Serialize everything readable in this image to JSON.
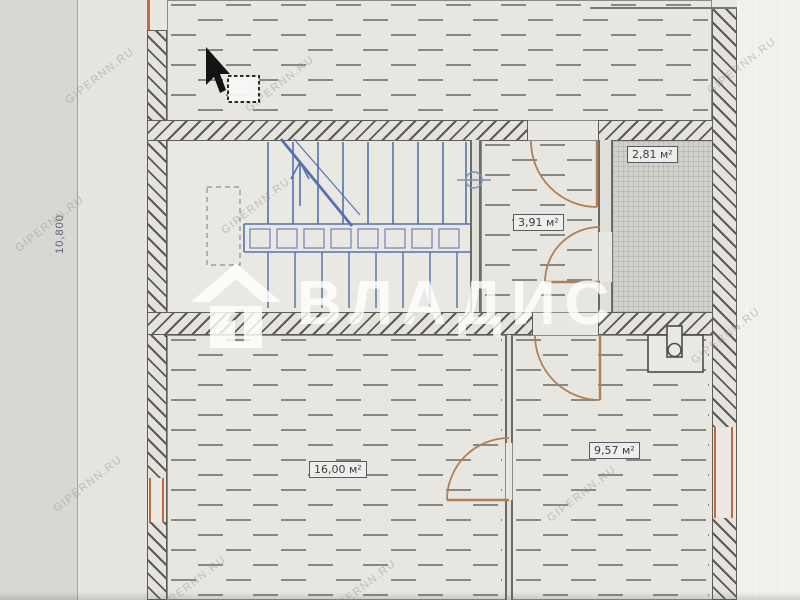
{
  "plan": {
    "rooms": [
      {
        "area_label": "2,81 м²"
      },
      {
        "area_label": "3,91 м²"
      },
      {
        "area_label": "16,00 м²"
      },
      {
        "area_label": "9,57 м²"
      }
    ],
    "dimension_left": "10,800"
  },
  "watermarks": {
    "brand": "ВЛАДИС",
    "site": "GIPERNN.RU"
  },
  "colors": {
    "stairs_blue": "#5472ae",
    "door_swing": "#b08055",
    "window_orange": "#c4693c",
    "wall_line": "#5b5952",
    "paper": "#e9e7e2",
    "service_room_fill": "#d2d0cb"
  }
}
